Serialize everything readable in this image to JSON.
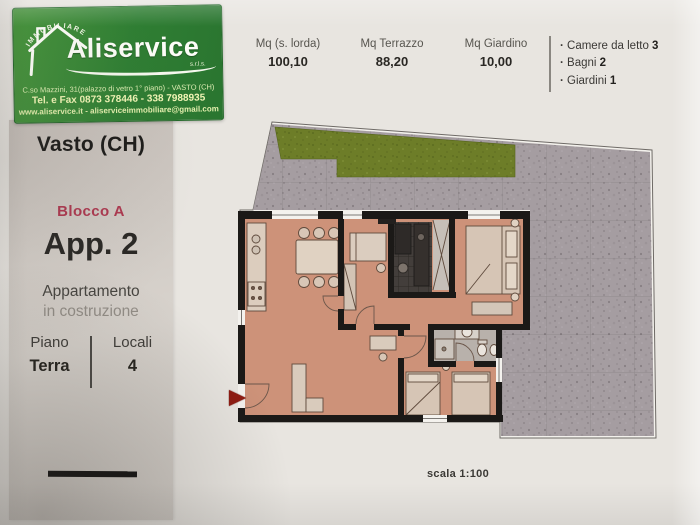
{
  "logo": {
    "arc_text": "IMMOBILIARE",
    "brand": "Aliservice",
    "brand_suffix": "s.r.l.s.",
    "address_line1": "C.so Mazzini, 31(palazzo di vetro 1° piano) - VASTO (CH)",
    "address_line2": "Tel. e Fax 0873 378446 - 338 7988935",
    "address_line3": "www.aliservice.it - aliserviceimmobiliare@gmail.com",
    "brand_green": "#2f7e33"
  },
  "header": {
    "stats": [
      {
        "label": "Mq (s. lorda)",
        "value": "100,10"
      },
      {
        "label": "Mq Terrazzo",
        "value": "88,20"
      },
      {
        "label": "Mq Giardino",
        "value": "10,00"
      }
    ],
    "features": [
      {
        "label": "Camere da letto ",
        "value": "3"
      },
      {
        "label": "Bagni ",
        "value": "2"
      },
      {
        "label": "Giardini ",
        "value": "1"
      }
    ]
  },
  "sidebar": {
    "city": "Vasto (CH)",
    "block": "Blocco A",
    "apartment": "App. 2",
    "property_type": "Appartamento",
    "status": "in costruzione",
    "floor_label": "Piano",
    "floor_value": "Terra",
    "rooms_label": "Locali",
    "rooms_value": "4",
    "block_accent": "#ad3950"
  },
  "plan": {
    "scale_label": "scala 1:100",
    "colors": {
      "wall": "#1b1917",
      "apartment_floor": "#cd9279",
      "terrace": "#a59da1",
      "garden": "#6d7d28",
      "entrance_marker": "#8e1b12"
    }
  }
}
